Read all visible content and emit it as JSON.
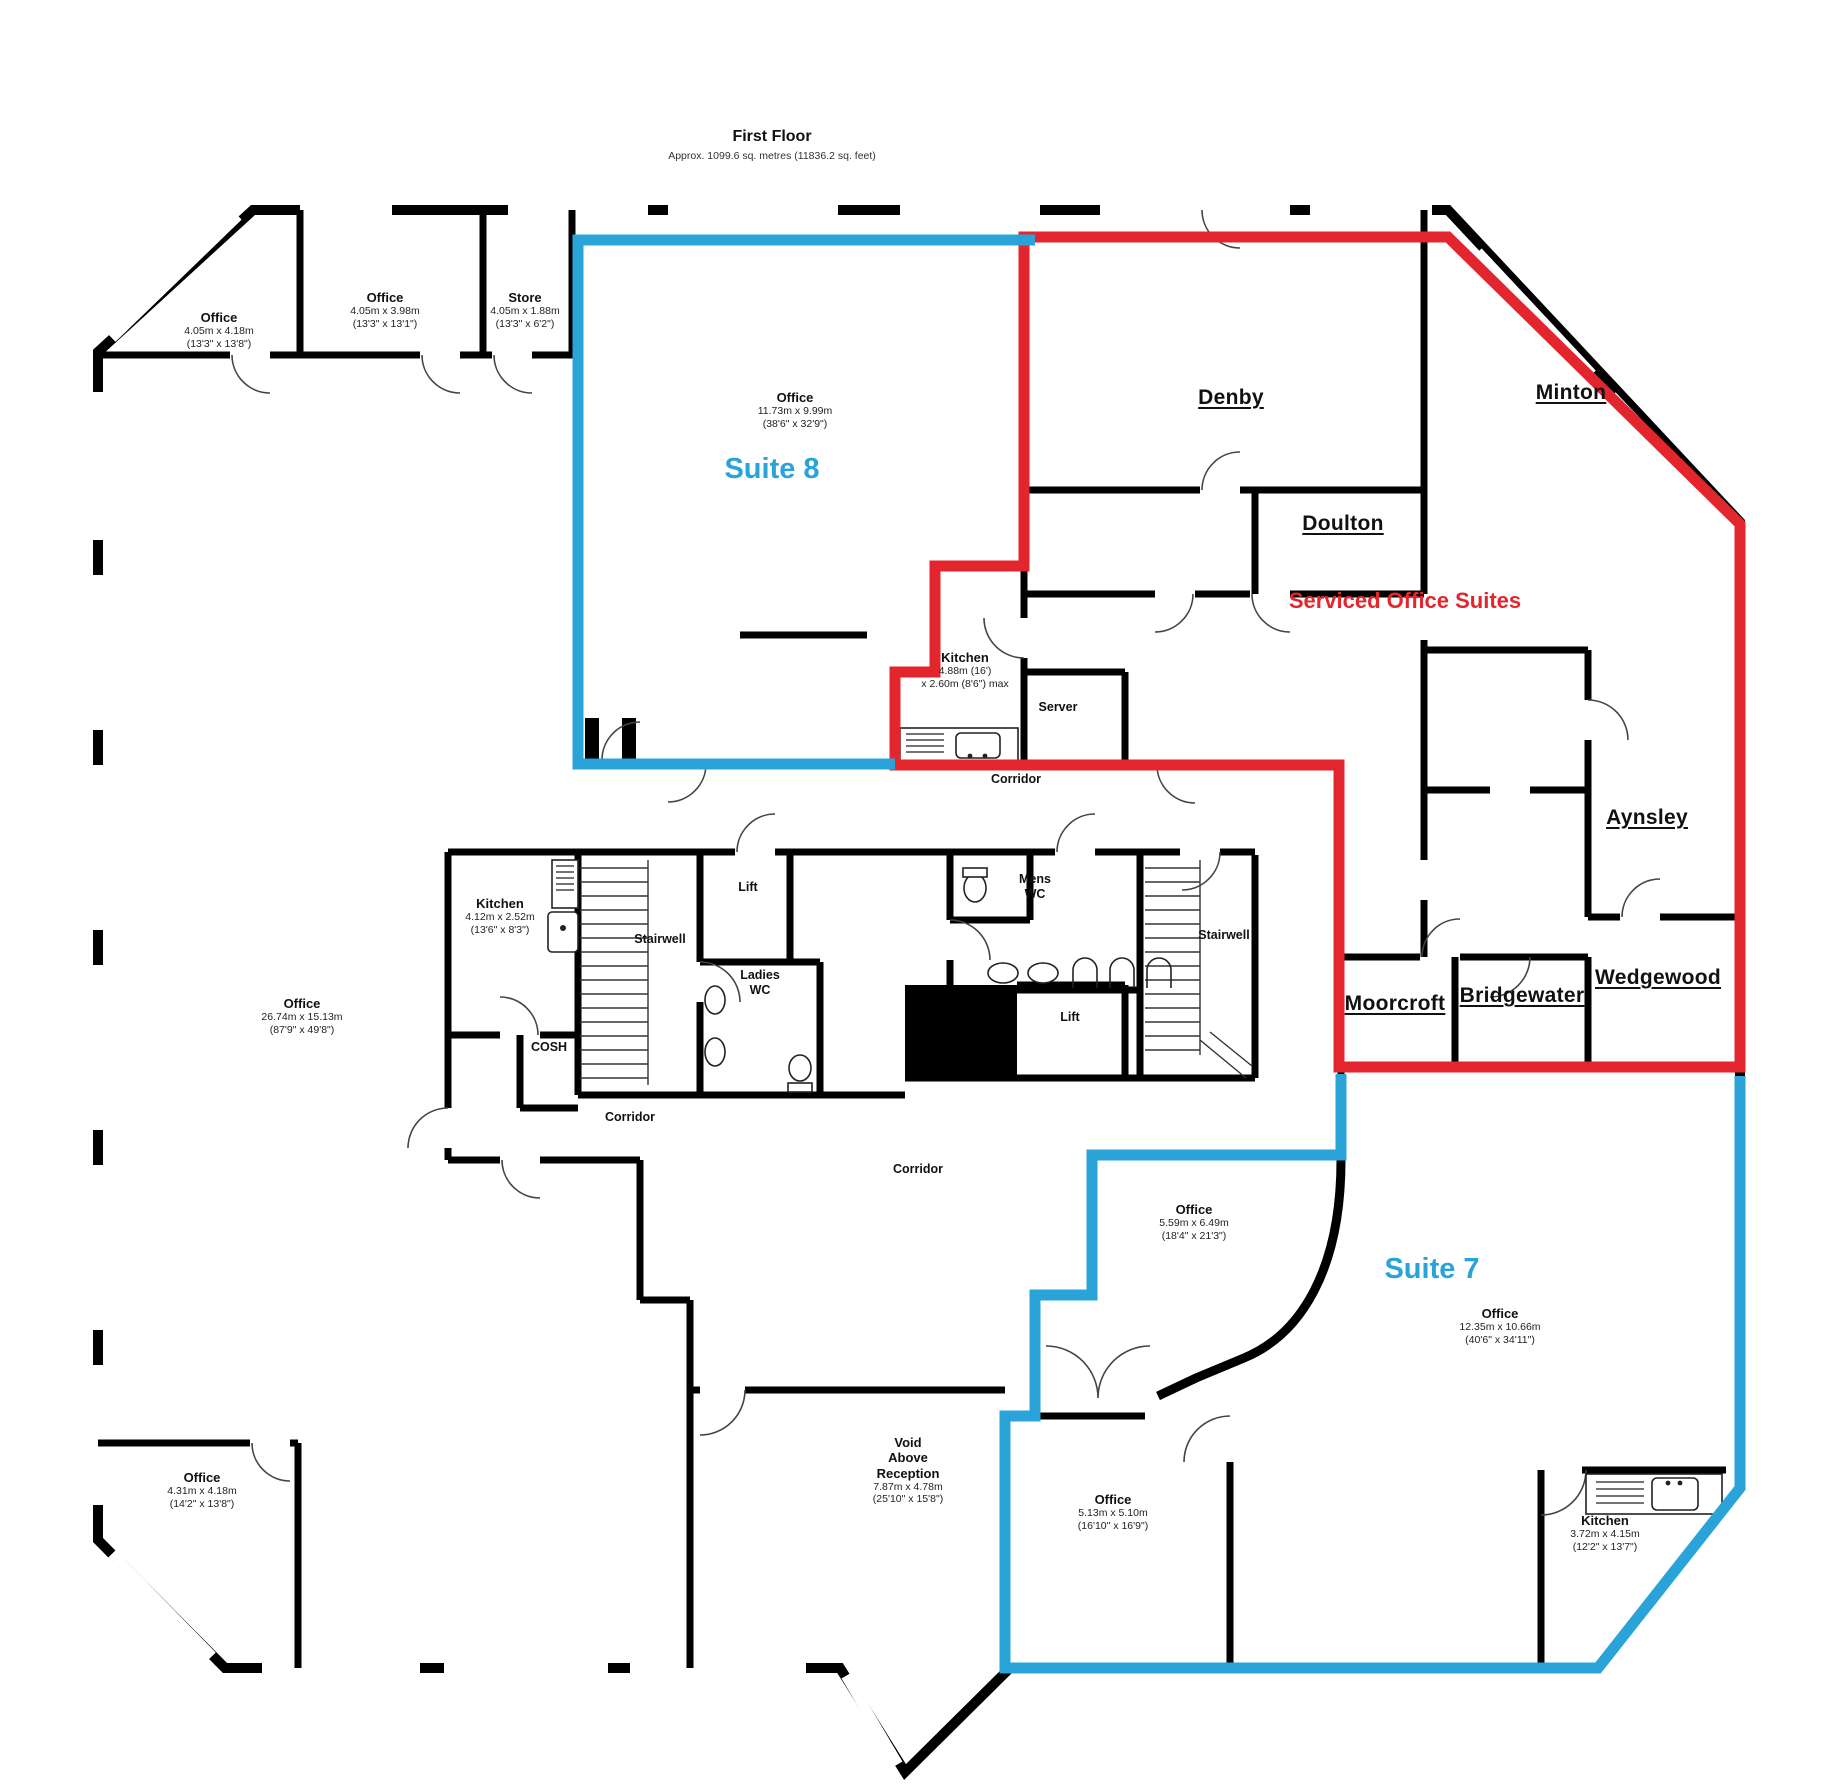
{
  "title": "First Floor",
  "subtitle": "Approx. 1099.6 sq. metres (11836.2 sq. feet)",
  "colors": {
    "accent_blue": "#29a3d8",
    "accent_red": "#e3262e",
    "wall": "#000000",
    "window_gray": "#9a9a9a"
  },
  "suites": {
    "suite8_label": "Suite 8",
    "suite7_label": "Suite 7",
    "serviced_label": "Serviced Office Suites"
  },
  "labels": [
    {
      "id": "floor-title",
      "x": 772,
      "y": 128,
      "style": "title",
      "lines": [
        "First Floor"
      ]
    },
    {
      "id": "floor-subtitle",
      "x": 772,
      "y": 150,
      "style": "sub",
      "lines": [
        "Approx. 1099.6 sq. metres (11836.2 sq. feet)"
      ]
    },
    {
      "id": "room-office-nw1",
      "x": 219,
      "y": 310,
      "style": "room",
      "lines": [
        "Office",
        "4.05m x 4.18m",
        "(13'3\" x 13'8\")"
      ]
    },
    {
      "id": "room-office-nw2",
      "x": 385,
      "y": 290,
      "style": "room",
      "lines": [
        "Office",
        "4.05m x 3.98m",
        "(13'3\" x 13'1\")"
      ]
    },
    {
      "id": "room-store",
      "x": 525,
      "y": 290,
      "style": "room",
      "lines": [
        "Store",
        "4.05m x 1.88m",
        "(13'3\" x 6'2\")"
      ]
    },
    {
      "id": "room-office-suite8",
      "x": 795,
      "y": 390,
      "style": "room",
      "lines": [
        "Office",
        "11.73m x 9.99m",
        "(38'6\" x 32'9\")"
      ]
    },
    {
      "id": "suite8-label",
      "x": 772,
      "y": 452,
      "style": "suite",
      "lines": [
        "Suite 8"
      ]
    },
    {
      "id": "room-denby",
      "x": 1231,
      "y": 386,
      "style": "name",
      "lines": [
        "Denby"
      ]
    },
    {
      "id": "room-minton",
      "x": 1571,
      "y": 381,
      "style": "name",
      "lines": [
        "Minton"
      ]
    },
    {
      "id": "room-doulton",
      "x": 1343,
      "y": 512,
      "style": "name",
      "lines": [
        "Doulton"
      ]
    },
    {
      "id": "serviced-label",
      "x": 1405,
      "y": 588,
      "style": "serviced",
      "lines": [
        "Serviced Office Suites"
      ]
    },
    {
      "id": "room-kitchen-suite8",
      "x": 965,
      "y": 650,
      "style": "room",
      "lines": [
        "Kitchen",
        "4.88m (16')",
        "x 2.60m (8'6\") max"
      ]
    },
    {
      "id": "room-server",
      "x": 1058,
      "y": 700,
      "style": "small",
      "lines": [
        "Server"
      ]
    },
    {
      "id": "corridor-north",
      "x": 1016,
      "y": 772,
      "style": "corridor",
      "lines": [
        "Corridor"
      ]
    },
    {
      "id": "room-aynsley",
      "x": 1647,
      "y": 806,
      "style": "name",
      "lines": [
        "Aynsley"
      ]
    },
    {
      "id": "room-wedgewood",
      "x": 1658,
      "y": 966,
      "style": "name",
      "lines": [
        "Wedgewood"
      ]
    },
    {
      "id": "room-moorcroft",
      "x": 1395,
      "y": 992,
      "style": "name",
      "lines": [
        "Moorcroft"
      ]
    },
    {
      "id": "room-bridgewater",
      "x": 1522,
      "y": 984,
      "style": "name",
      "lines": [
        "Bridgewater"
      ]
    },
    {
      "id": "room-kitchen-core",
      "x": 500,
      "y": 896,
      "style": "room",
      "lines": [
        "Kitchen",
        "4.12m x 2.52m",
        "(13'6\" x 8'3\")"
      ]
    },
    {
      "id": "room-stairwell-west",
      "x": 660,
      "y": 932,
      "style": "small",
      "lines": [
        "Stairwell"
      ]
    },
    {
      "id": "room-lift-west",
      "x": 748,
      "y": 880,
      "style": "small",
      "lines": [
        "Lift"
      ]
    },
    {
      "id": "room-ladies-wc",
      "x": 760,
      "y": 968,
      "style": "small",
      "lines": [
        "Ladies",
        "WC"
      ]
    },
    {
      "id": "room-cosh",
      "x": 549,
      "y": 1040,
      "style": "small",
      "lines": [
        "COSH"
      ]
    },
    {
      "id": "room-mens-wc",
      "x": 1035,
      "y": 872,
      "style": "small",
      "lines": [
        "Mens",
        "WC"
      ]
    },
    {
      "id": "room-lift-east",
      "x": 1070,
      "y": 1010,
      "style": "small",
      "lines": [
        "Lift"
      ]
    },
    {
      "id": "room-stairwell-east",
      "x": 1224,
      "y": 928,
      "style": "small",
      "lines": [
        "Stairwell"
      ]
    },
    {
      "id": "room-office-west",
      "x": 302,
      "y": 996,
      "style": "room",
      "lines": [
        "Office",
        "26.74m x 15.13m",
        "(87'9\" x 49'8\")"
      ]
    },
    {
      "id": "corridor-west",
      "x": 630,
      "y": 1110,
      "style": "corridor",
      "lines": [
        "Corridor"
      ]
    },
    {
      "id": "corridor-center",
      "x": 918,
      "y": 1162,
      "style": "corridor",
      "lines": [
        "Corridor"
      ]
    },
    {
      "id": "room-office-559",
      "x": 1194,
      "y": 1202,
      "style": "room",
      "lines": [
        "Office",
        "5.59m x 6.49m",
        "(18'4\" x 21'3\")"
      ]
    },
    {
      "id": "suite7-label",
      "x": 1432,
      "y": 1252,
      "style": "suite",
      "lines": [
        "Suite 7"
      ]
    },
    {
      "id": "room-office-1235",
      "x": 1500,
      "y": 1306,
      "style": "room",
      "lines": [
        "Office",
        "12.35m x 10.66m",
        "(40'6\" x 34'11\")"
      ]
    },
    {
      "id": "room-office-431",
      "x": 202,
      "y": 1470,
      "style": "room",
      "lines": [
        "Office",
        "4.31m x 4.18m",
        "(14'2\" x 13'8\")"
      ]
    },
    {
      "id": "room-void",
      "x": 908,
      "y": 1435,
      "style": "room-multi",
      "lines": [
        "Void",
        "Above",
        "Reception",
        "7.87m x 4.78m",
        "(25'10\" x 15'8\")"
      ],
      "bold": 3
    },
    {
      "id": "room-office-513",
      "x": 1113,
      "y": 1492,
      "style": "room",
      "lines": [
        "Office",
        "5.13m x 5.10m",
        "(16'10\" x 16'9\")"
      ]
    },
    {
      "id": "room-kitchen-suite7",
      "x": 1605,
      "y": 1513,
      "style": "room",
      "lines": [
        "Kitchen",
        "3.72m x 4.15m",
        "(12'2\" x 13'7\")"
      ]
    }
  ]
}
